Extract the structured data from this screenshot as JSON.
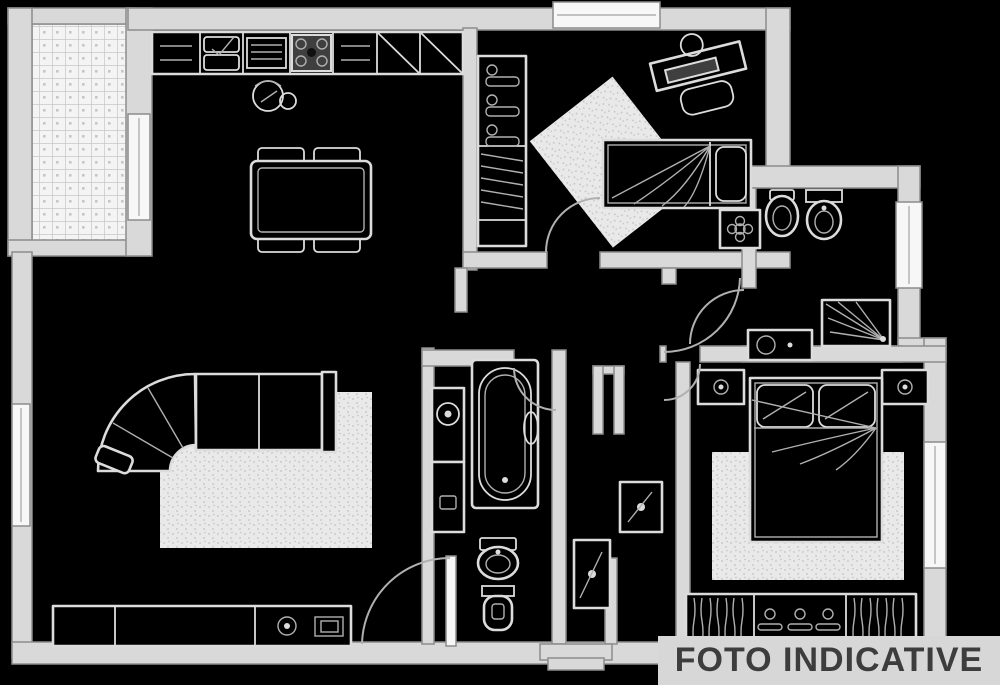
{
  "watermark": {
    "text": "FOTO INDICATIVE"
  },
  "palette": {
    "background": "#000000",
    "wall_fill": "#d9d9d9",
    "wall_stroke": "#8c8c8c",
    "window_fill": "#f7f7f7",
    "furniture_line": "#dcdcdc",
    "detail_line": "#b0b0b0",
    "dark_accent": "#3f3f3f",
    "rug_fill": "#e9e9e9",
    "rug_dot": "#c2c2c2",
    "tile_fill": "#f4f4f4",
    "tile_line": "#c6c6c6",
    "watermark_bg": "#d7d7d7",
    "watermark_color": "#3d3d3d"
  },
  "plan": {
    "type": "apartment-floor-plan",
    "rooms": [
      {
        "name": "terrace",
        "fixtures": [
          "tiled-floor",
          "terrace-window"
        ]
      },
      {
        "name": "kitchen",
        "fixtures": [
          "kitchen-counter",
          "double-sink",
          "dish-drainer",
          "cooktop",
          "corner-cabinet",
          "corner-cabinet",
          "kettle",
          "dining-table",
          "chair",
          "chair",
          "chair",
          "chair"
        ]
      },
      {
        "name": "hallway",
        "fixtures": [
          "coat-closet",
          "coat-hangers",
          "shelves",
          "duct-column",
          "hall-cabinet",
          "hall-cabinet"
        ]
      },
      {
        "name": "bedroom-1",
        "fixtures": [
          "desk",
          "desk-lamp",
          "laptop",
          "desk-chair",
          "single-bed",
          "rug",
          "plant-table"
        ]
      },
      {
        "name": "bathroom-1",
        "fixtures": [
          "bidet",
          "toilet",
          "shower",
          "vanity-sink",
          "window"
        ]
      },
      {
        "name": "bathroom-2",
        "fixtures": [
          "washing-machine",
          "cabinet",
          "bathtub",
          "washbasin",
          "toilet"
        ]
      },
      {
        "name": "living-room",
        "fixtures": [
          "corner-sofa",
          "rug",
          "sideboard",
          "tv",
          "speaker"
        ]
      },
      {
        "name": "bedroom-2",
        "fixtures": [
          "double-bed",
          "nightstand",
          "nightstand",
          "rug",
          "wardrobe",
          "window"
        ]
      },
      {
        "name": "entrance",
        "fixtures": [
          "entry-door",
          "outdoor-steps"
        ]
      }
    ]
  }
}
